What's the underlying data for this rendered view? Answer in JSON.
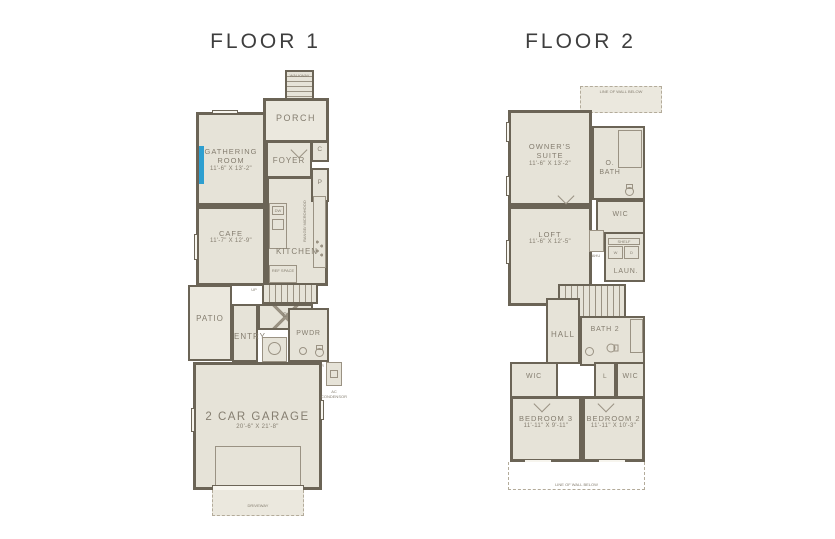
{
  "titles": {
    "floor1": "FLOOR 1",
    "floor2": "FLOOR 2"
  },
  "colors": {
    "wall": "#6b6456",
    "floor": "#e6e3d8",
    "outdoor": "#ebe8de",
    "text": "#857e70",
    "line": "#9a9283",
    "accent": "#2e9fd0",
    "dashline": "#b3ab9a",
    "title": "#3e3e3e"
  },
  "floor1": {
    "walkway": "WALKWAY",
    "walkway_dn": "DN",
    "porch": "PORCH",
    "gathering": {
      "label": "GATHERING ROOM",
      "dims": "11'-6\" X 13'-2\""
    },
    "foyer": "FOYER",
    "closet_c": "C",
    "pantry_p": "P",
    "cafe": {
      "label": "CAFE",
      "dims": "11'-7\" X 12'-9\""
    },
    "kitchen": "KITCHEN",
    "dw": "DW",
    "range": "RANGE/ MICROHOOD",
    "ref_space": "REF SPACE",
    "stairs_up": "UP",
    "closet_c2": "C2",
    "patio": "PATIO",
    "entry": "ENTRY",
    "powder": "PWDR",
    "tankless": "TANKLESS WATER HEATER",
    "garage": {
      "label": "2 CAR GARAGE",
      "dims": "20'-6\" X 21'-8\""
    },
    "driveway": "DRIVEWAY",
    "ac_condensor": "AC CONDENSOR"
  },
  "floor2": {
    "wall_below_top": "LINE OF WALL BELOW",
    "owners_suite": {
      "label": "OWNER'S SUITE",
      "dims": "11'-6\" X 13'-2\""
    },
    "owners_bath": "O. BATH",
    "wic_owner": "WIC",
    "loft": {
      "label": "LOFT",
      "dims": "11'-6\" X 12'-5\""
    },
    "ahu": "AHU",
    "shelf": "SHELF",
    "washer": "W",
    "dryer": "D",
    "laundry": "LAUN.",
    "stairs_dn": "DN",
    "hall": "HALL",
    "bath2": "BATH 2",
    "wic_bed3": "WIC",
    "linen": "L",
    "wic_bed2": "WIC",
    "bedroom3": {
      "label": "BEDROOM 3",
      "dims": "11'-11\" X 9'-11\""
    },
    "bedroom2": {
      "label": "BEDROOM 2",
      "dims": "11'-11\" X 10'-3\""
    },
    "wall_below_bottom": "LINE OF WALL BELOW"
  }
}
